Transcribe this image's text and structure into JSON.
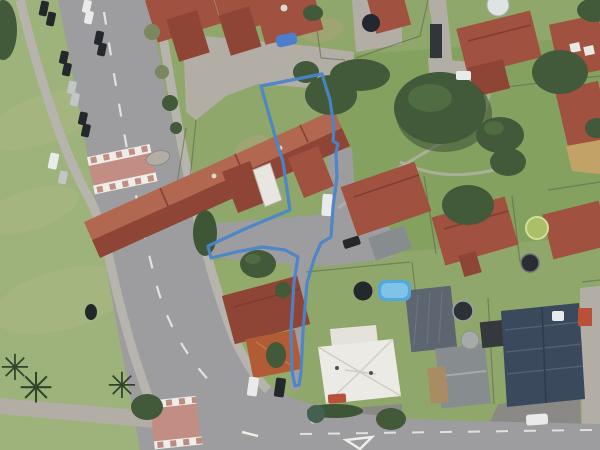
{
  "meta": {
    "view": "aerial-satellite-map",
    "overlay": "property-parcel-boundary",
    "description": "Aerial photo of a suburban block with a blue flag-shaped parcel boundary: rear section behind street-front units with a long driveway corridor to the road"
  },
  "palette": {
    "grass-base": "#8fa76b",
    "grass-park": "#9eb27b",
    "grass-ne": "#84a05e",
    "grass-low": "#92ad6c",
    "grass-streak": "#aab984",
    "dirt": "#b3a282",
    "asphalt": "#9d9da0",
    "asphalt-dark": "#8b8986",
    "pavement": "#b2aea5",
    "path": "#b6b4ac",
    "marking": "#eeede8",
    "crossing": "#c28e84",
    "fence": "#57614b",
    "roof-red": "#a0513f",
    "roof-red-dark": "#8e4536",
    "roof-red-light": "#b16750",
    "roof-edge": "#7a3a2d",
    "roof-orange": "#b25c36",
    "roof-white": "#eceae5",
    "roof-slate": "#5d6670",
    "roof-gray": "#878c8e",
    "roof-navy": "#3a495c",
    "tree": "#42593a",
    "tree-dark": "#31452c",
    "tree-light": "#5a7a48",
    "hedge": "#3f5636",
    "bush": "#79885f",
    "pool": "#53a7dc",
    "pool-light": "#7fc3e9",
    "car-dark": "#24272b",
    "car-white": "#e9eaea",
    "car-silver": "#c3c5c6",
    "car-blue": "#4d7ecb",
    "car-red": "#b8503a",
    "boundary": "#4a85c9"
  },
  "boundary": {
    "color": "#4a85c9",
    "stroke_width": 3.2,
    "shape": "flag-lot polygon with driveway corridor",
    "points": "261,86 322,74 330,100 334,128 333,141 338,144 336,153 337,177 333,207 331,237 321,243 314,259 307,283 303,331 301,372 299,385 295,386 292,371 291,331 294,282 298,257 285,250 262,247 236,252 211,258 208,246 247,228 290,210 283,162 275,136"
  },
  "features": {
    "roads": [
      "main-road-diagonal",
      "bottom-cross-street",
      "raised-crossing-north",
      "raised-crossing-south"
    ],
    "markings": [
      "centerline-dashes",
      "give-way-triangle"
    ],
    "vegetation": [
      "park-palms",
      "large-central-trees",
      "hedges"
    ],
    "structures": [
      "unit-row-red-roofs",
      "white-hip-roof-house",
      "slate-roof-house",
      "navy-roof-house",
      "orange-shed",
      "swimming-pool",
      "trampolines"
    ],
    "vehicles": [
      "street-parked-cars",
      "blue-tarp-car",
      "driveway-cars"
    ]
  }
}
